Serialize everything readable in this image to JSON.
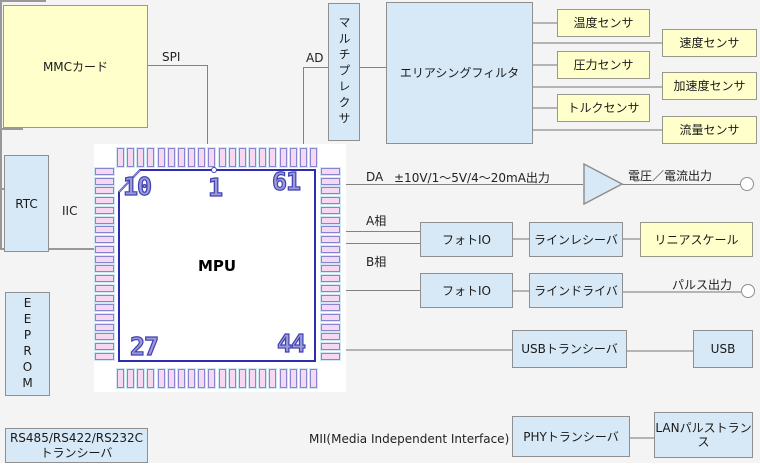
{
  "diagram": {
    "boxes": {
      "mmc": "MMCカード",
      "multiplexer": "マルチプレクサ",
      "aliasing_filter": "エリアシングフィルタ",
      "temp_sensor": "温度センサ",
      "speed_sensor": "速度センサ",
      "pressure_sensor": "圧力センサ",
      "accel_sensor": "加速度センサ",
      "torque_sensor": "トルクセンサ",
      "flow_sensor": "流量センサ",
      "rtc": "RTC",
      "eeprom": "EEPROM",
      "serial_transceiver_line1": "RS485/RS422/RS232C",
      "serial_transceiver_line2": "トランシーバ",
      "photo_io_1": "フォトIO",
      "line_receiver": "ラインレシーバ",
      "linear_scale": "リニアスケール",
      "photo_io_2": "フォトIO",
      "line_driver": "ラインドライバ",
      "usb_transceiver": "USBトランシーバ",
      "usb": "USB",
      "phy_transceiver": "PHYトランシーバ",
      "lan_pulse_transformer": "LANパルストランス"
    },
    "labels": {
      "spi": "SPI",
      "ad": "AD",
      "iic": "IIC",
      "da": "DA",
      "da_range": "±10V/1～5V/4～20mA出力",
      "voltage_current_output": "電圧／電流出力",
      "phase_a": "A相",
      "phase_b": "B相",
      "pulse_output": "パルス出力",
      "mii": "MII(Media Independent Interface)"
    },
    "chip": {
      "name": "MPU",
      "pin_numbers": {
        "top_left": "10",
        "top_center": "1",
        "top_right": "61",
        "bottom_left": "27",
        "bottom_right": "44"
      },
      "pins_per_side": {
        "top": 20,
        "bottom": 20,
        "left": 20,
        "right": 20
      }
    },
    "colors": {
      "background": "#f4f4f4",
      "box_blue": "#d7e9f6",
      "box_yellow": "#ffffcc",
      "box_border": "#8f8f8f",
      "wire": "#828282",
      "chip_body_border": "#2e2ead",
      "pin_fill": "#f8d8f0",
      "pin_border": "#8585d2",
      "pin_number": "#4040b4"
    }
  }
}
